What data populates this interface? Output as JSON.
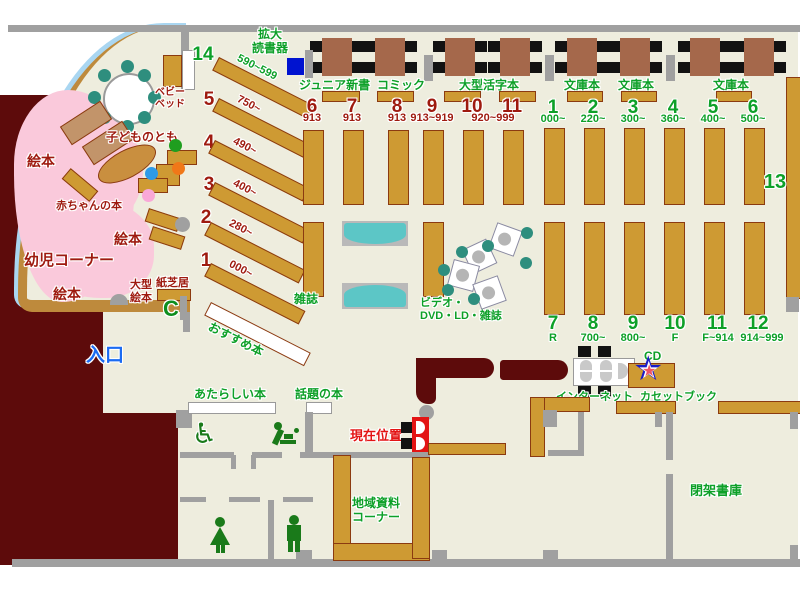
{
  "colors": {
    "floor": "#EEEDDE",
    "wall": "#A0A0A0",
    "restricted_area": "#5D0B0B",
    "shelf": "#CE9A33",
    "green_text": "#0DA028",
    "dark_red_text": "#9E1A0F",
    "entrance_blue": "#1B6BF2",
    "infant_pink": "#FAC9DB",
    "sofa_teal": "#5CC6C6",
    "chair_teal": "#2E8E7E",
    "current_red": "#E31414",
    "device_blue": "#0013D0"
  },
  "labels": {
    "magnifier_l1": "拡大",
    "magnifier_l2": "読書器",
    "junior_shinsho": "ジュニア新書",
    "comic": "コミック",
    "large_print": "大型活字本",
    "bunko1": "文庫本",
    "bunko2": "文庫本",
    "bunko3": "文庫本",
    "baby_bed_l1": "ベビー",
    "baby_bed_l2": "ベッド",
    "kodomo_no_tomo": "子どものとも",
    "ehon1": "絵本",
    "ehon2": "絵本",
    "ehon3": "絵本",
    "akachan_books": "赤ちゃんの本",
    "infant_corner": "幼児コーナー",
    "ogata_ehon_l1": "大型",
    "ogata_ehon_l2": "絵本",
    "kamishibai": "紙芝居",
    "osusume": "おすすめ本",
    "zasshi": "雑誌",
    "video_l1": "ビデオ・",
    "video_l2": "DVD・LD・雑誌",
    "entrance": "入口",
    "new_books": "あたらしい本",
    "topic_books": "話題の本",
    "current_position": "現在位置",
    "internet": "インターネット",
    "cd": "CD",
    "cassette_book": "カセットブック",
    "local_docs_l1": "地域資料",
    "local_docs_l2": "コーナー",
    "closed_stacks": "閉架書庫",
    "shelf13": "13",
    "phone_c": "C",
    "star": "★",
    "wheelchair": "♿"
  },
  "diagonal_shelves": [
    {
      "num": "14",
      "range": "590~599"
    },
    {
      "num": "5",
      "range": "750~"
    },
    {
      "num": "4",
      "range": "490~"
    },
    {
      "num": "3",
      "range": "400~"
    },
    {
      "num": "2",
      "range": "280~"
    },
    {
      "num": "1",
      "range": "000~"
    }
  ],
  "upper_red": [
    {
      "num": "6",
      "range": "913"
    },
    {
      "num": "7",
      "range": "913"
    },
    {
      "num": "8",
      "range": "913"
    },
    {
      "num": "9",
      "range": "913~919"
    },
    {
      "num": "10",
      "range": ""
    },
    {
      "num": "11",
      "range": ""
    }
  ],
  "upper_red_shared_range": "920~999",
  "upper_green": [
    {
      "num": "1",
      "range": "000~"
    },
    {
      "num": "2",
      "range": "220~"
    },
    {
      "num": "3",
      "range": "300~"
    },
    {
      "num": "4",
      "range": "360~"
    },
    {
      "num": "5",
      "range": "400~"
    },
    {
      "num": "6",
      "range": "500~"
    }
  ],
  "lower_green": [
    {
      "num": "7",
      "range": "R"
    },
    {
      "num": "8",
      "range": "700~"
    },
    {
      "num": "9",
      "range": "800~"
    },
    {
      "num": "10",
      "range": "F"
    },
    {
      "num": "11",
      "range": "F~914"
    },
    {
      "num": "12",
      "range": "914~999"
    }
  ]
}
